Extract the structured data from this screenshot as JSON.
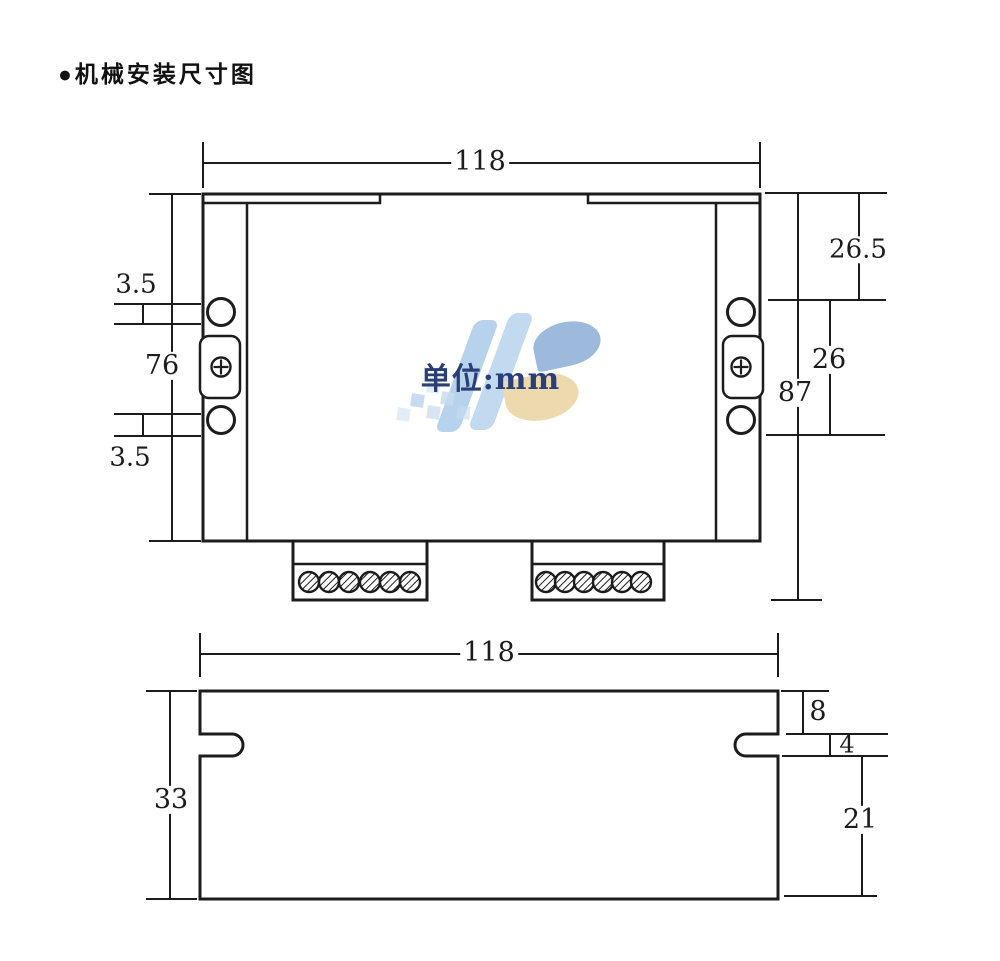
{
  "page": {
    "title": "●机械安装尺寸图"
  },
  "watermark": {
    "text": "单位:mm",
    "logo_name": "HS-logo"
  },
  "top_view": {
    "width": "118",
    "offset_top": "3.5",
    "span": "76",
    "offset_bottom": "3.5",
    "right_top": "26.5",
    "right_mid": "26",
    "total": "87"
  },
  "side_view": {
    "width": "118",
    "height": "33",
    "top_to_slot": "8",
    "slot_height": "4",
    "slot_to_bottom": "21"
  },
  "colors": {
    "line": "#1c1c1c",
    "watermark_text": "#2b3f77",
    "logo_blue": "#b7d2ec",
    "logo_blue2": "#9db9dc",
    "logo_tan": "#ecd9ae",
    "logo_check": "#c7dcf0"
  }
}
